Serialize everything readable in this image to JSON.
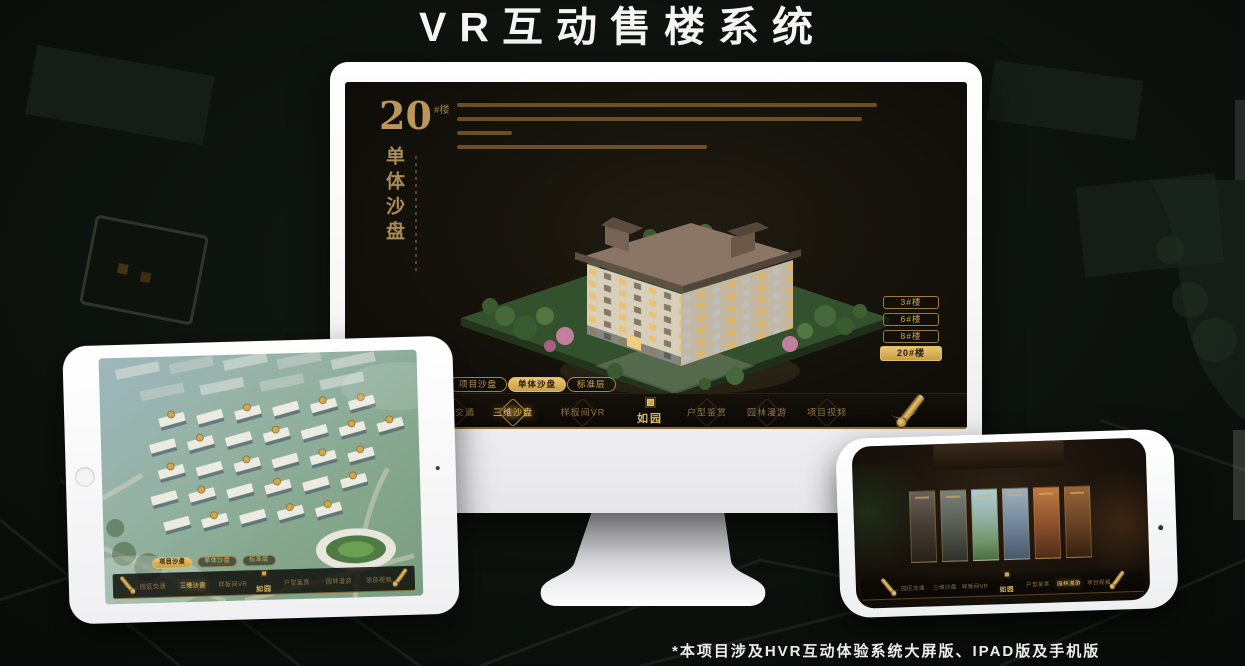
{
  "page": {
    "title": "VR互动售楼系统",
    "footnote": "*本项目涉及HVR互动体验系统大屏版、IPAD版及手机版"
  },
  "colors": {
    "gold": "#c9a258",
    "gold_bright": "#e8c06a",
    "gold_dim": "#8f7848",
    "active_button_bg": "#d9ae5f",
    "screen_bg": "#14110b",
    "device_white": "#f4f4f6",
    "title_white": "#f5f5f5"
  },
  "icons": {
    "scroll": "scroll-icon",
    "seal": "seal-icon",
    "home": "home-button",
    "camera": "camera-dot"
  },
  "monitor": {
    "panel": {
      "number": "20",
      "number_unit": "#楼",
      "subtitle": "单体沙盘"
    },
    "floor_buttons": [
      {
        "label": "3#楼",
        "active": false
      },
      {
        "label": "6#楼",
        "active": false
      },
      {
        "label": "8#楼",
        "active": false
      },
      {
        "label": "20#楼",
        "active": true
      }
    ],
    "mode_tabs": [
      {
        "label": "项目沙盘",
        "active": false
      },
      {
        "label": "单体沙盘",
        "active": true
      },
      {
        "label": "标准层",
        "active": false
      }
    ],
    "nav": {
      "left_items": [
        {
          "label": "园区交通",
          "active": false
        },
        {
          "label": "三维沙盘",
          "active": true
        },
        {
          "label": "样板间VR",
          "active": false
        }
      ],
      "logo": "如园",
      "right_items": [
        {
          "label": "户型鉴赏",
          "active": false
        },
        {
          "label": "园林漫游",
          "active": false
        },
        {
          "label": "项目视频",
          "active": false
        }
      ]
    }
  },
  "ipad": {
    "mode_tabs": [
      {
        "label": "项目沙盘",
        "active": true
      },
      {
        "label": "单体沙盘",
        "active": false
      },
      {
        "label": "标准层",
        "active": false
      }
    ],
    "nav": {
      "left_items": [
        {
          "label": "园区交通",
          "active": false
        },
        {
          "label": "三维沙盘",
          "active": true
        },
        {
          "label": "样板间VR",
          "active": false
        }
      ],
      "logo": "如园",
      "right_items": [
        {
          "label": "户型鉴赏",
          "active": false
        },
        {
          "label": "园林漫游",
          "active": false
        },
        {
          "label": "项目视频",
          "active": false
        }
      ]
    }
  },
  "phone": {
    "nav": {
      "left_items": [
        {
          "label": "园区交通",
          "active": false
        },
        {
          "label": "三维沙盘",
          "active": false
        },
        {
          "label": "样板间VR",
          "active": false
        }
      ],
      "logo": "如园",
      "right_items": [
        {
          "label": "户型鉴赏",
          "active": false
        },
        {
          "label": "园林漫游",
          "active": true
        },
        {
          "label": "项目视频",
          "active": false
        }
      ]
    }
  }
}
